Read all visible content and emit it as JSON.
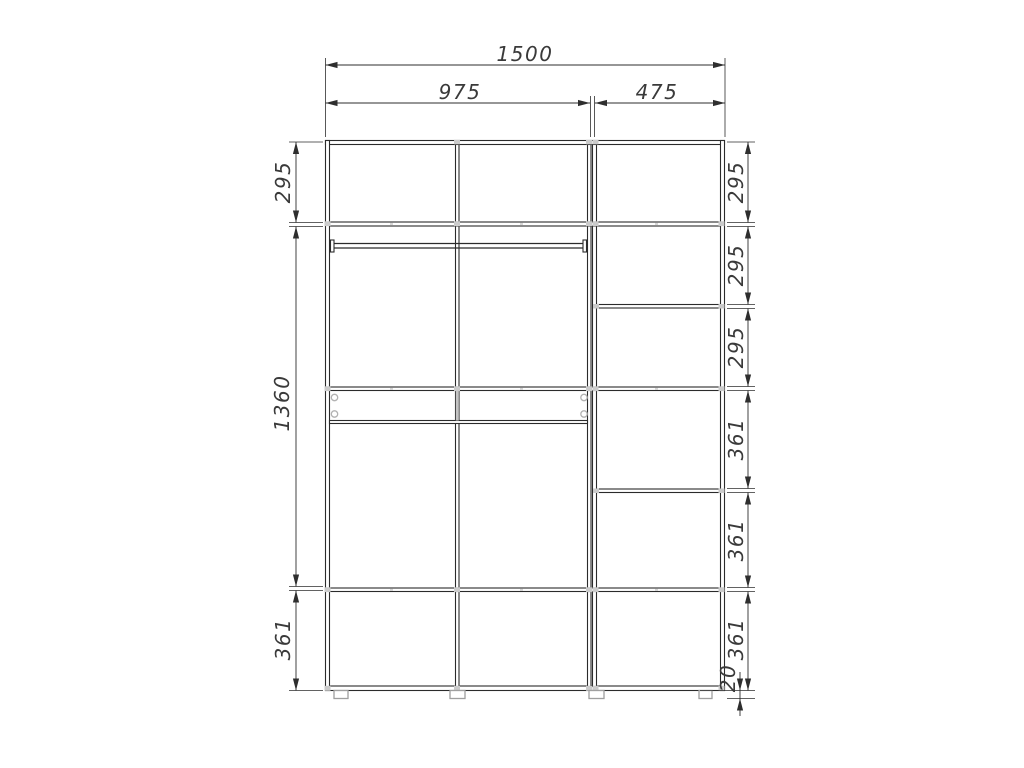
{
  "page": {
    "background": "#ffffff",
    "line_color": "#2b2b2b",
    "fitting_gray": "#cbcbcb"
  },
  "drawing": {
    "kind": "wardrobe-interior-dimension-diagram",
    "dims": {
      "total_width": "1500",
      "left_section_width": "975",
      "right_section_width": "475",
      "left_heights": [
        "295",
        "1360",
        "361"
      ],
      "right_heights": [
        "295",
        "295",
        "295",
        "361",
        "361",
        "361"
      ],
      "plinth_height": "20"
    }
  }
}
